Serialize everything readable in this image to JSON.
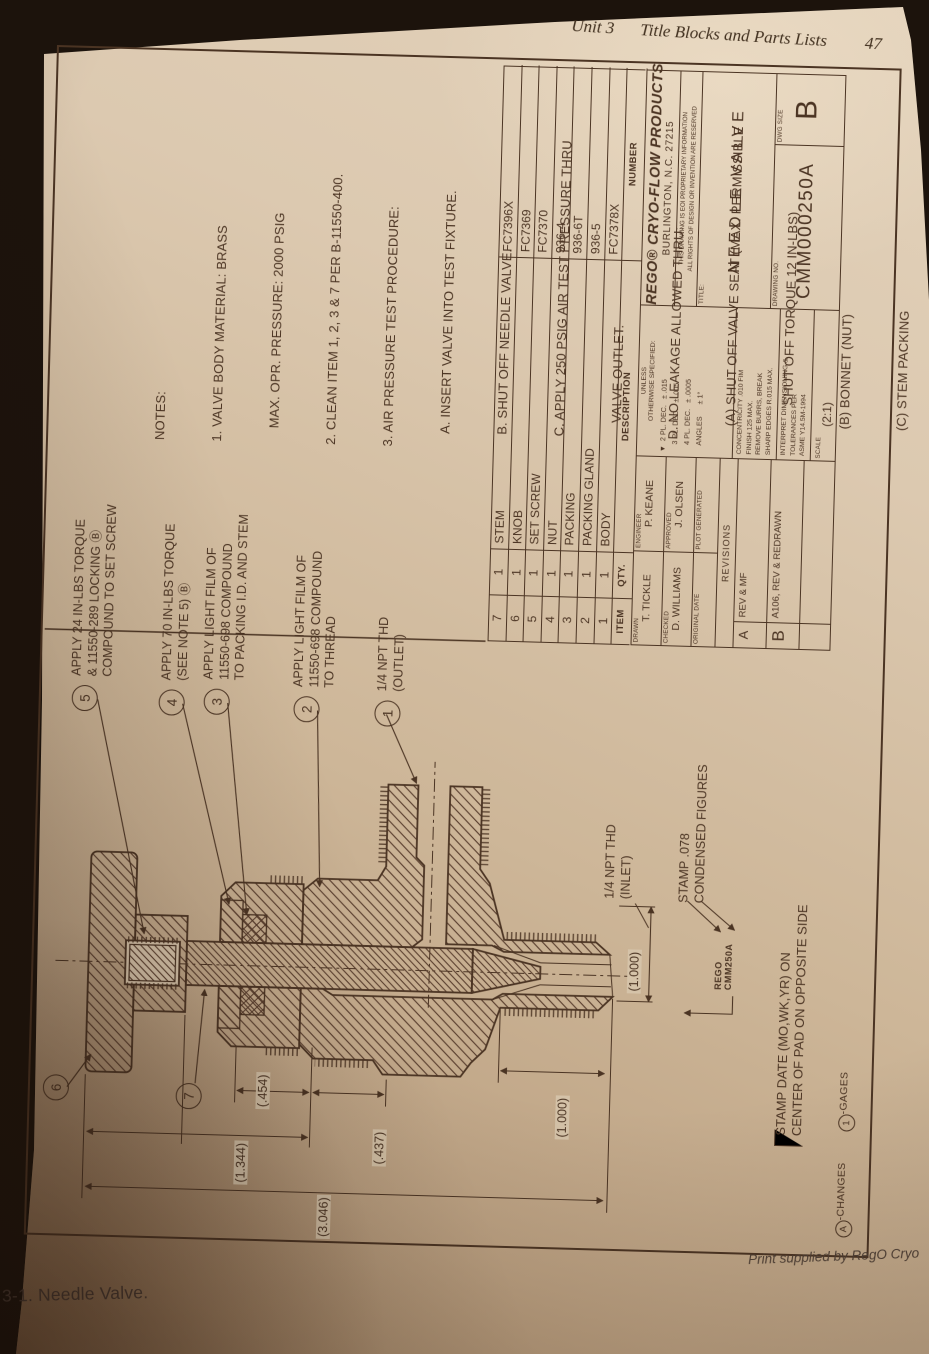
{
  "photo": {
    "header": {
      "unit": "Unit 3",
      "chapter_title": "Title Blocks and Parts Lists",
      "page_number": "47"
    },
    "caption": "3-1. Needle Valve.",
    "print_credit": "Print supplied by RegO Cryo"
  },
  "notes": {
    "lines": [
      "NOTES:",
      "1. VALVE BODY MATERIAL: BRASS",
      "    MAX. OPR. PRESSURE: 2000 PSIG",
      "2. CLEAN ITEM 1, 2, 3 & 7 PER B-11550-400.",
      "3. AIR PRESSURE TEST PROCEDURE:",
      "    A. INSERT VALVE INTO TEST FIXTURE.",
      "    B. SHUT OFF NEEDLE VALVE.",
      "    C. APPLY 250 PSIG AIR TEST PRESSURE THRU",
      "        VALVE OUTLET.",
      "    D. NO LEAKAGE ALLOWED THRU:",
      "        (A) SHUT OFF VALVE SEAT (MAX. PERMISSIBLE",
      "              SHUT OFF TORQUE 12 IN-LBS)",
      "        (B) BONNET (NUT)",
      "        (C) STEM PACKING",
      "    E. ANY LEAKAGE IS CAUSE FOR REJECTION, REPAIR",
      "        AND RETEST.",
      "4. INCLUDE LABEL 11564-5 IN BAG AND SEAL.",
      "Ⓑ 5. AFTER 48 HOURS TORQUE SHOULD BE",
      "    50 ±10 IN-LBS."
    ]
  },
  "callouts": [
    {
      "num": "5",
      "lines": [
        "APPLY 24 IN-LBS TORQUE",
        "& 11550-289 LOCKING Ⓑ",
        "COMPOUND TO SET SCREW"
      ]
    },
    {
      "num": "4",
      "lines": [
        "APPLY 70 IN-LBS TORQUE",
        "(SEE NOTE 5)  Ⓑ"
      ]
    },
    {
      "num": "3",
      "lines": [
        "APPLY LIGHT FILM OF",
        "11550-698 COMPOUND",
        "TO PACKING I.D. AND STEM"
      ]
    },
    {
      "num": "2",
      "lines": [
        "APPLY LIGHT FILM OF",
        "11550-698 COMPOUND",
        "TO THREAD"
      ]
    },
    {
      "num": "1",
      "lines": [
        "1/4 NPT THD",
        "(OUTLET)"
      ]
    },
    {
      "num": "6",
      "lines": []
    },
    {
      "num": "7",
      "lines": []
    }
  ],
  "dimensions": {
    "overall": "(3.046)",
    "upper": "(1.344)",
    "packing": "(.454)",
    "mid": "(.437)",
    "lower": "(1.000)",
    "inlet_width": "(1.000)"
  },
  "inlet": {
    "line1": "1/4 NPT THD",
    "line2": "(INLET)"
  },
  "stamp": {
    "caption_line1": "STAMP .078",
    "caption_line2": "CONDENSED FIGURES",
    "sample_line1": "REGO",
    "sample_line2": "CMM250A",
    "date_line1": "STAMP DATE (MO,WK,YR) ON",
    "date_line2": "CENTER OF PAD ON OPPOSITE SIDE"
  },
  "corner_legend": {
    "changes_symbol": "A",
    "changes_label": "-CHANGES",
    "gages_symbol": "1",
    "gages_label": "-GAGES"
  },
  "parts_list": {
    "headers": [
      "ITEM",
      "QTY.",
      "DESCRIPTION",
      "NUMBER"
    ],
    "rows": [
      [
        "7",
        "1",
        "STEM",
        "FC7396X"
      ],
      [
        "6",
        "1",
        "KNOB",
        "FC7369"
      ],
      [
        "5",
        "1",
        "SET SCREW",
        "FC7370"
      ],
      [
        "4",
        "1",
        "NUT",
        "936-4"
      ],
      [
        "3",
        "1",
        "PACKING",
        "936-6T"
      ],
      [
        "2",
        "1",
        "PACKING GLAND",
        "936-5"
      ],
      [
        "1",
        "1",
        "BODY",
        "FC7378X"
      ]
    ]
  },
  "title_block": {
    "drawn_label": "DRAWN",
    "drawn": "T. TICKLE",
    "engineer_label": "ENGINEER",
    "engineer": "P. KEANE",
    "checked_label": "CHECKED",
    "checked": "D. WILLIAMS",
    "approved_label": "APPROVED",
    "approved": "J. OLSEN",
    "original_date_label": "ORIGINAL DATE",
    "plot_generated_label": "PLOT GENERATED",
    "revisions_label": "REVISIONS",
    "revisions": [
      {
        "letter": "A",
        "text": "REV & MF"
      },
      {
        "letter": "B",
        "text": "A106, REV & REDRAWN"
      }
    ],
    "tol_heading1": "UNLESS",
    "tol_heading2": "OTHERWISE SPECIFIED:",
    "tol_rows": [
      "▼  2 PL. DEC.   ± .015",
      "    3 PL. DEC.   ± .005",
      "    4 PL. DEC.   ± .0005",
      "    ANGLES      ± 1°"
    ],
    "finish_notes": [
      "CONCENTRICITY .010 FIM",
      "FINISH 125 MAX.",
      "REMOVE BURRS, BREAK",
      "SHARP EDGES R.015 MAX."
    ],
    "interpret_notes": [
      "INTERPRET DIMENSIONING &",
      "TOLERANCES PER",
      "ASME Y14.5M-1994"
    ],
    "scale_label": "SCALE",
    "scale_value": "(2:1)",
    "company_name": "REGO® CRYO-FLOW PRODUCTS",
    "company_address": "BURLINGTON, N.C.  27215",
    "proprietary_line1": "THIS DRAWING IS EOI PROPRIETARY INFORMATION",
    "proprietary_line2": "ALL RIGHTS OF DESIGN OR INVENTION ARE RESERVED",
    "title_label": "TITLE:",
    "title_value": "NEEDLE VALVE",
    "drawing_no_label": "DRAWING NO.",
    "drawing_no": "CMM000250A",
    "dwg_size_label": "DWG SIZE",
    "dwg_size": "B"
  },
  "ink_color": "#4b3423"
}
